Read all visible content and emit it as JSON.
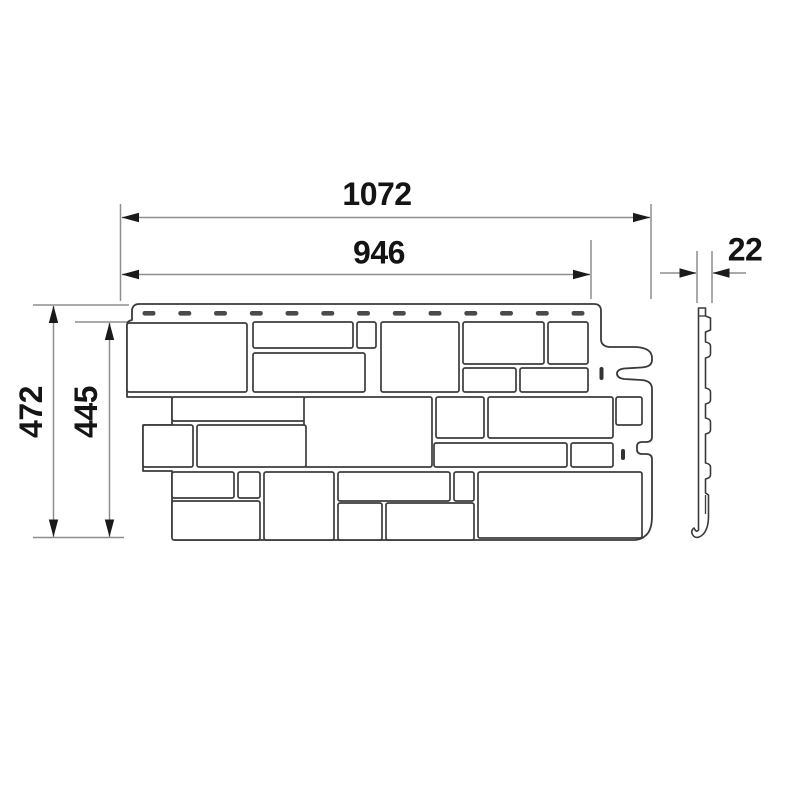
{
  "drawing": {
    "title": "facade-panel-dimension-drawing",
    "front_view": {
      "name": "panel-front-view"
    },
    "side_view": {
      "name": "panel-side-profile"
    },
    "dimensions": {
      "overall_width": {
        "value": "1072"
      },
      "exposed_width": {
        "value": "946"
      },
      "overall_height": {
        "value": "472"
      },
      "exposed_height": {
        "value": "445"
      },
      "thickness": {
        "value": "22"
      }
    },
    "colors": {
      "background": "#ffffff",
      "outline": "#3a3a3a",
      "dimension_line": "#8e8e8e",
      "arrow_and_text": "#141414",
      "slot_fill": "#4a4a4a"
    }
  }
}
